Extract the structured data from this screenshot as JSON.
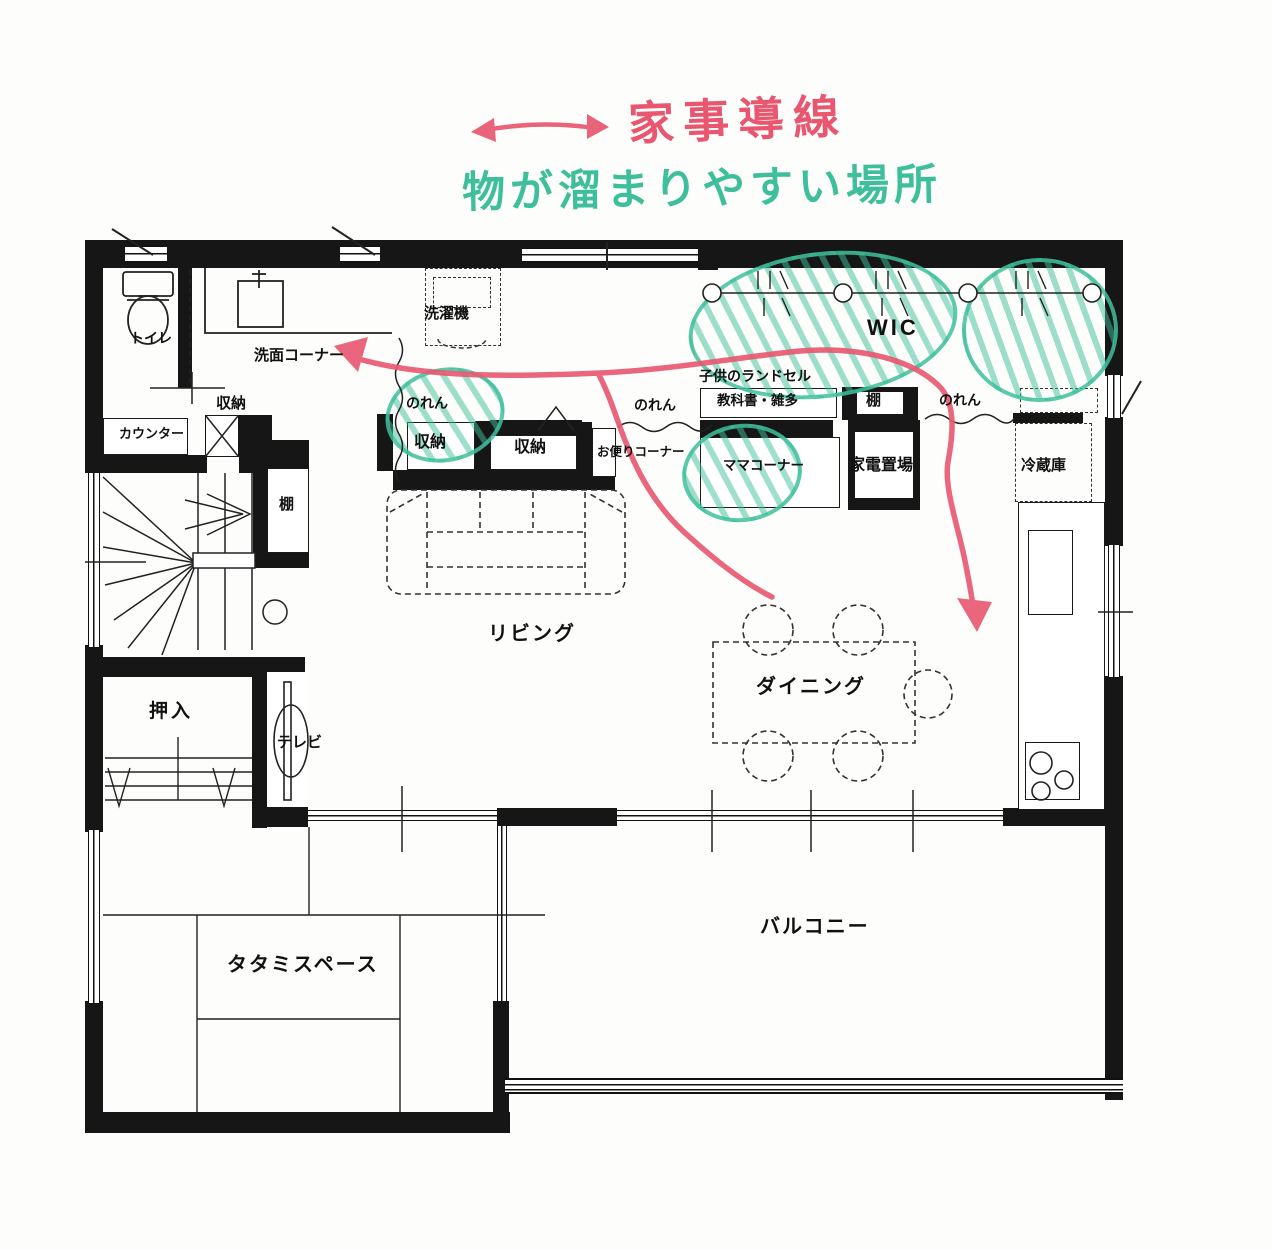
{
  "annotations": {
    "flow": "家事導線",
    "clutter": "物が溜まりやすい場所"
  },
  "labels": {
    "toilet": "トイレ",
    "washroom": "洗面コーナー",
    "storage": "収納",
    "counter": "カウンター",
    "shelf": "棚",
    "washer": "洗濯機",
    "noren": "のれん",
    "mail_corner": "お便りコーナー",
    "kids_bag": "子供のランドセル",
    "textbooks": "教科書・雑多",
    "wic": "WIC",
    "mama_corner": "ママコーナー",
    "appliance_area": "家電置場",
    "fridge": "冷蔵庫",
    "living": "リビング",
    "dining": "ダイニング",
    "oshiire": "押入",
    "tv": "テレビ",
    "tatami": "タタミスペース",
    "balcony": "バルコニー"
  },
  "colors": {
    "pink": "#e8566f",
    "green": "#3ebf9b",
    "wall": "#161616"
  }
}
